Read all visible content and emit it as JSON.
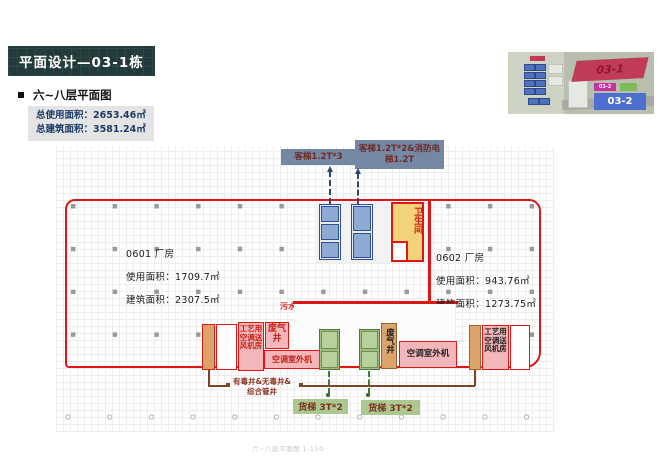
{
  "colors": {
    "accent_red": "#e01616",
    "title_bg": "#223a3a",
    "slate_label": "#7488a6",
    "pink_room": "#f3b6ba",
    "orange_shaft": "#dca469",
    "green_lift": "#9fbe82",
    "yellow_toilet": "#f2d37c"
  },
  "page": {
    "title": "平面设计—03-1栋",
    "subtitle": "六~八层平面图",
    "summary": {
      "usable": "总使用面积：2653.46㎡",
      "built": "总建筑面积：3581.24㎡"
    },
    "footer": "六~八层平面图 1:150"
  },
  "site_map": {
    "building_03_1": "03-1",
    "building_03_2": "03-2",
    "chip_03_2": "03-2"
  },
  "plan": {
    "lift_labels": {
      "passenger_left": "客梯1.2T*3",
      "passenger_right": "客梯1.2T*2&消防电梯1.2T"
    },
    "units": [
      {
        "name": "0601 厂房",
        "usable": "使用面积：1709.7㎡",
        "built": "建筑面积：2307.5㎡"
      },
      {
        "name": "0602 厂房",
        "usable": "使用面积：943.76㎡",
        "built": "建筑面积：1273.75㎡"
      }
    ],
    "rooms": {
      "toilet": "卫生间",
      "ahu_left": "工艺用空调送风机房",
      "ahu_right": "工艺用空调送风机房",
      "outdoor_left": "空调室外机",
      "outdoor_right": "空调室外机"
    },
    "shafts": {
      "sewage": "污水井",
      "exhaust_left": "废气井",
      "exhaust_center": "废气井",
      "note": "有毒井&无毒井&综合管井"
    },
    "freight": {
      "left": "货梯 3T*2",
      "right": "货梯 3T*2"
    }
  }
}
